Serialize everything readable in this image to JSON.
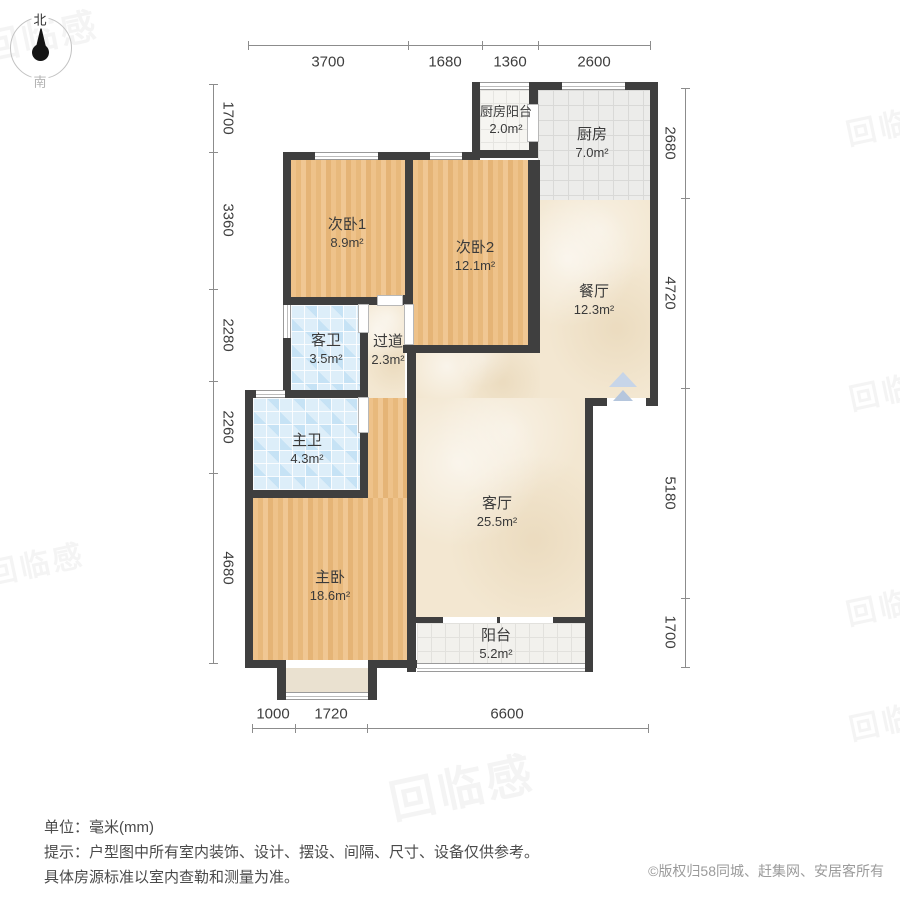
{
  "compass": {
    "north": "北",
    "south": "南"
  },
  "rooms": {
    "kitchen_balcony": {
      "name": "厨房阳台",
      "area": "2.0m²"
    },
    "kitchen": {
      "name": "厨房",
      "area": "7.0m²"
    },
    "bedroom2_1": {
      "name": "次卧1",
      "area": "8.9m²"
    },
    "bedroom2_2": {
      "name": "次卧2",
      "area": "12.1m²"
    },
    "dining": {
      "name": "餐厅",
      "area": "12.3m²"
    },
    "guest_bath": {
      "name": "客卫",
      "area": "3.5m²"
    },
    "hallway": {
      "name": "过道",
      "area": "2.3m²"
    },
    "master_bath": {
      "name": "主卫",
      "area": "4.3m²"
    },
    "living": {
      "name": "客厅",
      "area": "25.5m²"
    },
    "master_bedroom": {
      "name": "主卧",
      "area": "18.6m²"
    },
    "balcony": {
      "name": "阳台",
      "area": "5.2m²"
    }
  },
  "dims": {
    "top": [
      "3700",
      "1680",
      "1360",
      "2600"
    ],
    "bottom": [
      "1000",
      "1720",
      "6600"
    ],
    "left": [
      "1700",
      "3360",
      "2280",
      "2260",
      "4680"
    ],
    "right": [
      "2680",
      "4720",
      "5180",
      "1700"
    ]
  },
  "footer": {
    "unit": "单位：毫米(mm)",
    "tip1": "提示：户型图中所有室内装饰、设计、摆设、间隔、尺寸、设备仅供参考。",
    "tip2": "具体房源标准以室内查勒和测量为准。",
    "copyright": "©版权归58同城、赶集网、安居客所有"
  },
  "watermark": {
    "text": "回临感"
  },
  "colors": {
    "wall": "#3f3f3f",
    "wood_floor": "#eabf83",
    "marble_floor": "#f3e7d1",
    "bath_tile": "#ddeef9",
    "kitchen_tile": "#ececea",
    "balcony_tile": "#f2f1ed",
    "entry_arrow": "#c7d5e8"
  }
}
